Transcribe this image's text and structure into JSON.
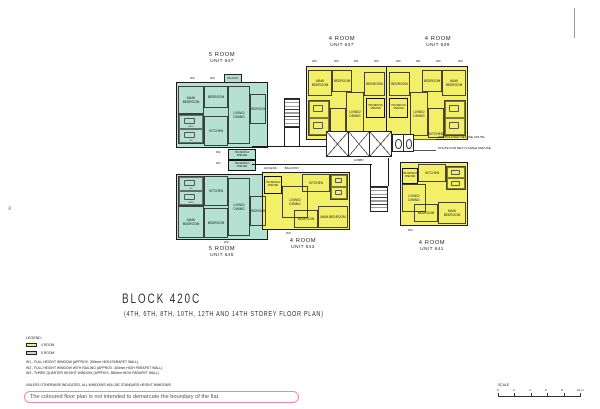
{
  "page_number": "91",
  "title": {
    "block": "BLOCK 420C",
    "subtitle": "(4TH, 6TH, 8TH, 10TH, 12TH AND 14TH STOREY FLOOR PLAN)"
  },
  "units": {
    "u647": {
      "type": "5 ROOM",
      "number": "UNIT 647"
    },
    "u645": {
      "type": "5 ROOM",
      "number": "UNIT 645"
    },
    "u637": {
      "type": "4 ROOM",
      "number": "UNIT 637"
    },
    "u639": {
      "type": "4 ROOM",
      "number": "UNIT 639"
    },
    "u643": {
      "type": "4 ROOM",
      "number": "UNIT 643"
    },
    "u641": {
      "type": "4 ROOM",
      "number": "UNIT 641"
    }
  },
  "labels": {
    "main_bedroom": "MAIN BEDROOM",
    "bedroom": "BEDROOM",
    "living_dining": "LIVING/ DINING",
    "kitchen": "KITCHEN",
    "balcony": "BALCONY",
    "household_shelter": "HOUSEHOLD SHELTER",
    "lobby": "LOBBY",
    "access_balcony": "ACCESS BALCONY",
    "bath": "BATH",
    "wc": "WC"
  },
  "annotations": {
    "refuse_chute": "CENTRALISED REFUSE CHUTE",
    "recyclable_chute": "CHUTE FOR RECYCLABLE REFUSE"
  },
  "window_marks": {
    "w1": "W1",
    "w2": "W2",
    "w3": "W3"
  },
  "legend": {
    "heading": "LEGEND:",
    "four_room": "4 ROOM",
    "five_room": "5 ROOM"
  },
  "notes": {
    "w1": "W1 - FULL HEIGHT WINDOW (APPROX. 300mm HIGH PARAPET WALL)",
    "w2": "W2 - FULL HEIGHT WINDOW WITH RAILING (APPROX. 300mm HIGH PARAPET WALL)",
    "w3": "W3 - THREE QUARTER HEIGHT WINDOW (APPROX. 550mm HIGH PARAPET WALL)",
    "general": "UNLESS OTHERWISE INDICATED, ALL WINDOWS WILL BE STANDARD HEIGHT WINDOWS"
  },
  "disclaimer": "The coloured floor plan is not intended to demarcate the boundary of the flat.",
  "scale": {
    "label": "SCALE",
    "ticks": [
      "0",
      "2",
      "4",
      "6",
      "8",
      "10 m"
    ]
  },
  "colors": {
    "four_room_fill": "#f3ef69",
    "five_room_fill": "#b4e1d1",
    "wall": "#1a1a1a",
    "disclaimer_border": "#ee86ad"
  }
}
